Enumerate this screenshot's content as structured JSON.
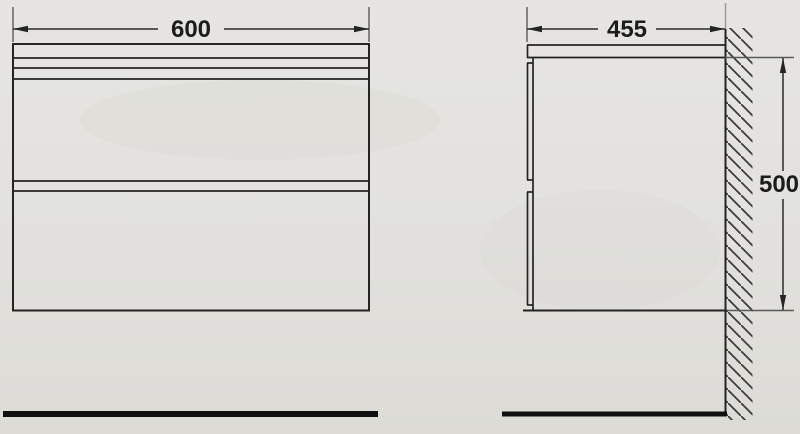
{
  "drawing": {
    "type": "furniture-dimension-drawing",
    "colors": {
      "background": "#e3e2de",
      "object_line": "#242424",
      "floor_line": "#101010",
      "hatch_line": "#3c3c3c"
    },
    "front_view": {
      "description": "front view, two-drawer wall-hung cabinet",
      "width_label": "600"
    },
    "side_view": {
      "description": "side view against hatched wall",
      "depth_label": "455",
      "height_label": "500"
    }
  }
}
